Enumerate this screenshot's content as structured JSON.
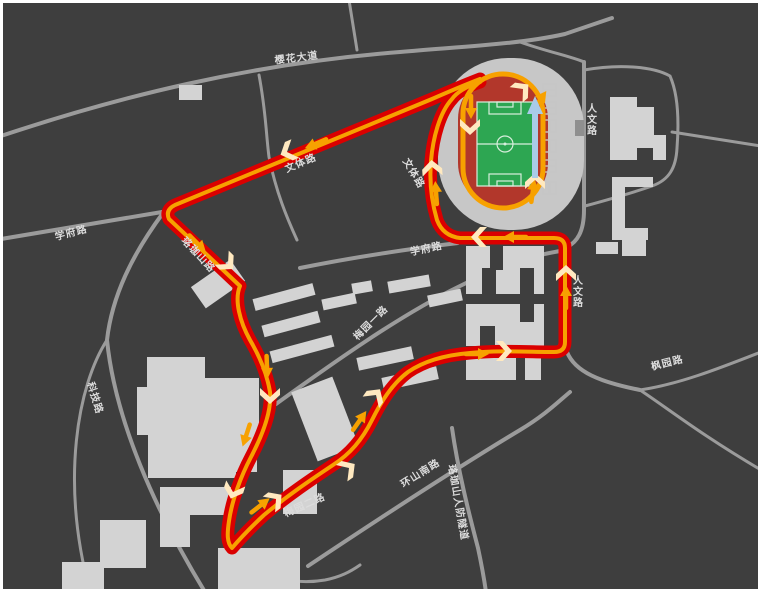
{
  "map": {
    "kind": "campus-running-route-map",
    "colors": {
      "background": "#3e3e3e",
      "border": "#ffffff",
      "road": "#9b9b9b",
      "building": "#d3d3d3",
      "stadium_apron": "#c7c7c7",
      "track": "#b2372b",
      "field": "#2da652",
      "field_lines": "#d8eedd",
      "route": "#da0000",
      "route_core": "#f7a100",
      "direction_marker": "#ffe9c0",
      "finish_arrow": "#a9cbe8",
      "label": "#dcdcdc"
    },
    "road_labels": [
      {
        "id": "yinghua-avenue",
        "text": "樱花大道"
      },
      {
        "id": "renwen-road-north",
        "text": "人文路"
      },
      {
        "id": "wenti-road-diagonal",
        "text": "文体路"
      },
      {
        "id": "wenti-road-vertical",
        "text": "文体路"
      },
      {
        "id": "xuefu-road-west",
        "text": "学府路"
      },
      {
        "id": "luojiashan-road",
        "text": "珞珈山路"
      },
      {
        "id": "xuefu-road-center",
        "text": "学府路"
      },
      {
        "id": "meiyuan-1st-road",
        "text": "梅园一路"
      },
      {
        "id": "renwen-road-east",
        "text": "人文路"
      },
      {
        "id": "fengyuan-road",
        "text": "枫园路"
      },
      {
        "id": "keji-road",
        "text": "科技路"
      },
      {
        "id": "meiyuan-2nd-road",
        "text": "梅园二路"
      },
      {
        "id": "huanshan-south-road",
        "text": "环山南路"
      },
      {
        "id": "luojiashan-tunnel",
        "text": "珞珈山人防隧道"
      }
    ],
    "icons": {
      "direction-chevron-icon": "chevron (pale cream, shows running direction)",
      "route-arrow-icon": "orange arrow along route core",
      "finish-direction-arrow-icon": "light-blue up arrow on stadium home straight",
      "stadium-icon": "oval athletics track with green soccer field",
      "sports-courts-icon": "small court diagrams beside track"
    }
  }
}
